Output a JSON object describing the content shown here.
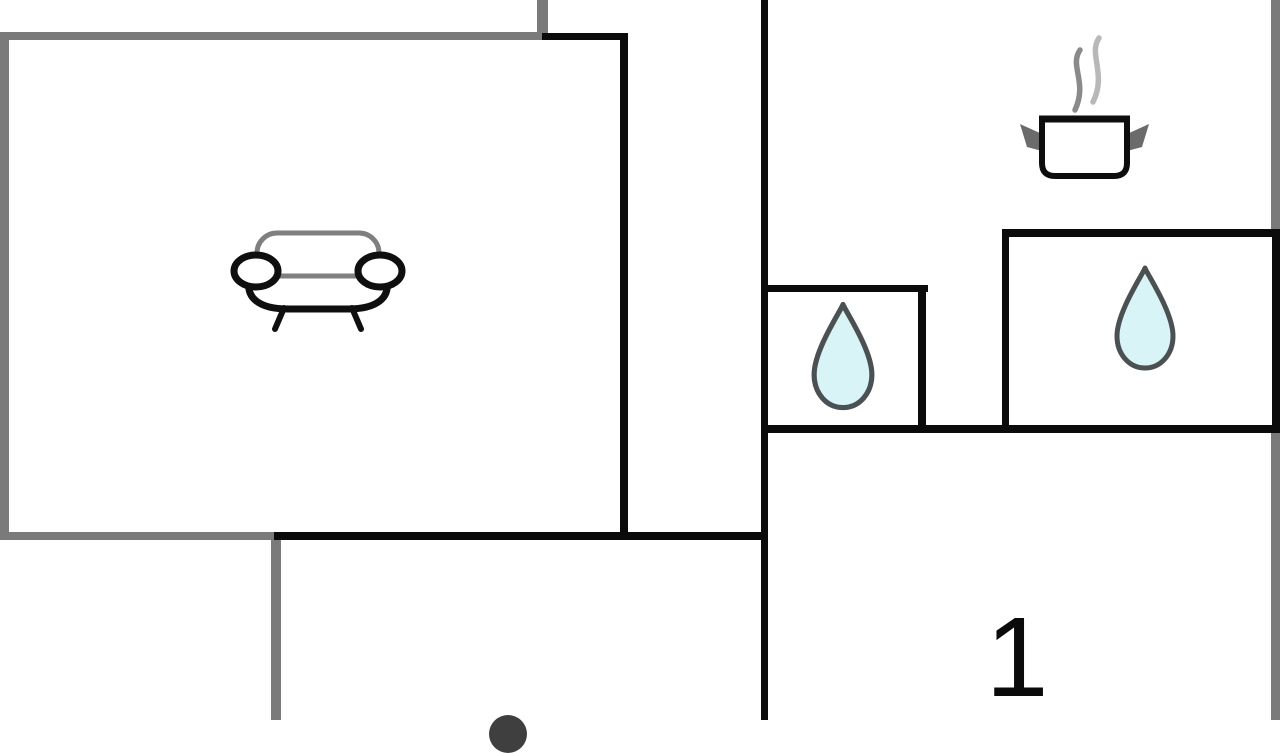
{
  "app": {
    "type": "floor-plan",
    "description": "cottage floor plan with furniture and fixture icons"
  },
  "labels": {
    "room1": "1"
  },
  "colors": {
    "background": "#ffffff",
    "wall_black": "#0b0b0b",
    "wall_gray": "#7a7a7a",
    "sofa_back_gray": "#7f7f7f",
    "sofa_ink": "#0f0f0f",
    "pot_ink": "#0d0d0d",
    "pot_handle_gray": "#6b6b6b",
    "steam_dark": "#8a8a8a",
    "steam_light": "#b8b8b8",
    "drop_fill": "#d8f4f7",
    "drop_stroke": "#4b5052",
    "dome_gray": "#3f3f3f",
    "number_ink": "#0a0a0a"
  },
  "rooms": [
    {
      "name": "living-room",
      "icon": "sofa-icon"
    },
    {
      "name": "hallway",
      "icon": null
    },
    {
      "name": "kitchen",
      "icon": "cooking-pot-icon"
    },
    {
      "name": "bathroom-small",
      "icon": "water-drop-icon"
    },
    {
      "name": "bathroom-large",
      "icon": "water-drop-icon"
    },
    {
      "name": "bedroom-1",
      "label": "1"
    },
    {
      "name": "room-bottom",
      "icon": "partial-round-object"
    }
  ],
  "walls": {
    "gray": [
      [
        0,
        32,
        548,
        8
      ],
      [
        537,
        0,
        11,
        36
      ],
      [
        0,
        32,
        9,
        508
      ],
      [
        0,
        532,
        282,
        8
      ],
      [
        271,
        532,
        10,
        188
      ],
      [
        1271,
        0,
        9,
        232
      ],
      [
        1271,
        433,
        9,
        287
      ]
    ],
    "black": [
      [
        542,
        33,
        86,
        7
      ],
      [
        620,
        33,
        8,
        506
      ],
      [
        274,
        532,
        494,
        8
      ],
      [
        761,
        0,
        7,
        720
      ],
      [
        761,
        285,
        167,
        7
      ],
      [
        918,
        285,
        8,
        148
      ],
      [
        761,
        425,
        519,
        8
      ],
      [
        1002,
        229,
        278,
        8
      ],
      [
        1002,
        229,
        7,
        204
      ],
      [
        1272,
        229,
        8,
        204
      ]
    ]
  },
  "icons": {
    "sofa": {
      "x": 228,
      "y": 226,
      "w": 180,
      "h": 106
    },
    "pot": {
      "x": 1012,
      "y": 30,
      "w": 145,
      "h": 150
    },
    "drop_small": {
      "x": 810,
      "y": 300,
      "w": 66,
      "h": 112
    },
    "drop_large": {
      "x": 1113,
      "y": 264,
      "w": 64,
      "h": 108
    },
    "dome": {
      "x": 489,
      "y": 715,
      "w": 38,
      "h": 38
    }
  },
  "label_positions": {
    "room1": {
      "cx": 1017,
      "cy": 659
    }
  }
}
